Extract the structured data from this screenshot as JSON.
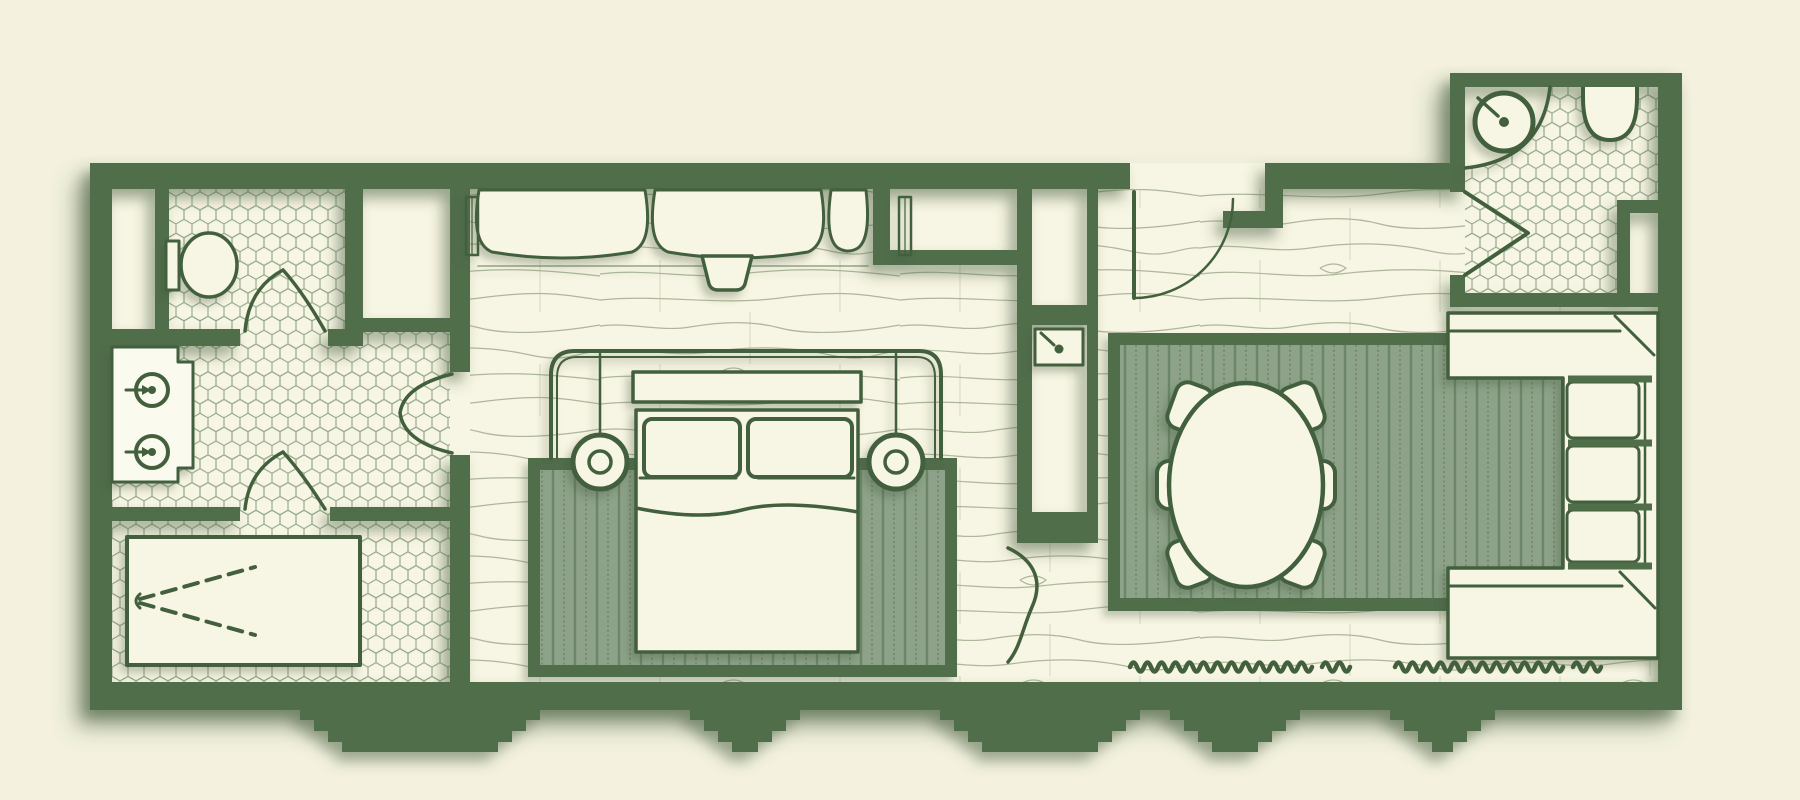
{
  "meta": {
    "kind": "architectural-floor-plan",
    "view": "top-down",
    "canvas_width": 1800,
    "canvas_height": 800,
    "text_labels": []
  },
  "colors": {
    "bg": "#f4f2df",
    "floor": "#f7f5e3",
    "wall": "#516e4c",
    "line": "#43603c",
    "hexline": "#93a78c",
    "woodline": "#aeb79b",
    "rugbase": "#8da289",
    "rugstripe": "#6c8768",
    "shadow": "#3d5639",
    "white": "#fbfaef"
  },
  "plan": {
    "rooms": [
      {
        "id": "primary-bathroom",
        "floor_finish": "hex-mosaic-tile",
        "fixtures": [
          "double-vanity-counter",
          "round-sink",
          "round-sink",
          "toilet",
          "walk-in-shower",
          "shower-spray-symbol",
          "linen-closet",
          "storage-closet",
          "double-swing-door-toilet-room",
          "double-swing-door-shower",
          "double-swing-door-to-bedroom"
        ]
      },
      {
        "id": "bedroom",
        "floor_finish": "plank-wood",
        "furniture": [
          "king-bed",
          "pillow-left",
          "pillow-right",
          "duvet",
          "headboard",
          "canopy-rail",
          "pendant-lamp-left",
          "pendant-lamp-right",
          "striped-area-rug",
          "curtain-panel-1",
          "curtain-panel-2",
          "curtain-panel-3",
          "curtain-tieback-tray",
          "window-mullion-left",
          "window-mullion-right",
          "wardrobe-niche"
        ]
      },
      {
        "id": "service-core",
        "floor_finish": "plank-wood",
        "fixtures": [
          "wet-bar-sink",
          "upper-niche",
          "lower-niche",
          "curved-passage-door"
        ]
      },
      {
        "id": "living-dining",
        "floor_finish": "plank-wood",
        "furniture": [
          "oval-dining-table",
          "dining-chair-1",
          "dining-chair-2",
          "dining-chair-3",
          "dining-chair-4",
          "dining-chair-5",
          "dining-chair-6",
          "striped-area-rug",
          "sectional-sofa",
          "radiator-baseboard-left",
          "radiator-baseboard-right",
          "entry-door"
        ]
      },
      {
        "id": "guest-bathroom",
        "floor_finish": "hex-mosaic-tile",
        "fixtures": [
          "corner-sink",
          "toilet",
          "bifold-door",
          "storage-niche"
        ]
      }
    ],
    "door_count": 6,
    "sink_count": 4,
    "toilet_count": 2,
    "rug_count": 2,
    "dining_chair_count": 6
  }
}
